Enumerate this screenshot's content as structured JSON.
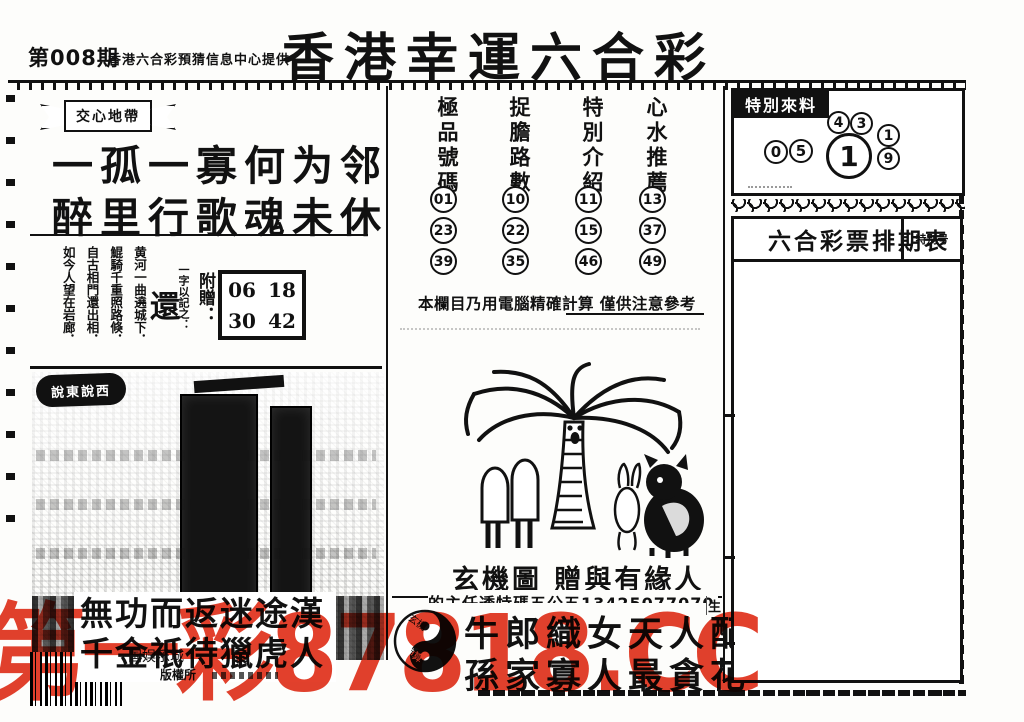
{
  "header": {
    "issue": "第008期",
    "provider": "香港六合彩預猜信息中心提供",
    "title": "香港幸運六合彩"
  },
  "left_panel": {
    "banner": "交心地帶",
    "poem_line1": "一孤一寡何为邻",
    "poem_line2": "醉里行歌魂未休",
    "verse_columns": [
      "黄河一曲遶城下．",
      "鯤騎千重照路倏．",
      "自古相門還出相．",
      "如今人望在岩廊．"
    ],
    "one_word_label": "一字以記之：",
    "one_word": "還",
    "bonus_label": "附贈：",
    "bonus_numbers": [
      [
        "06",
        "18"
      ],
      [
        "30",
        "42"
      ]
    ],
    "gossip_banner": "說東說西",
    "big_line1": "無功而返迷途漢",
    "big_line2": "千金祇待獵虎人",
    "small_text1": "国娱乐城",
    "small_text2": "版權所"
  },
  "middle_panel": {
    "columns": [
      {
        "header": "極品號碼",
        "numbers": [
          "01",
          "23",
          "39"
        ]
      },
      {
        "header": "捉膽路數",
        "numbers": [
          "10",
          "22",
          "35"
        ]
      },
      {
        "header": "特別介紹",
        "numbers": [
          "11",
          "15",
          "46"
        ]
      },
      {
        "header": "心水推薦",
        "numbers": [
          "13",
          "37",
          "49"
        ]
      }
    ],
    "note": "本欄目乃用電腦精確計算 僅供注意參考",
    "mystic_caption": "玄機圖 贈與有緣人",
    "cut_line": "的主任透特碼五公五13425077070",
    "yinyang_top": "玄機",
    "yinyang_bottom": "神算",
    "couplet_line1": "牛郎織女天人配",
    "couplet_line2": "孫家寡人最貪花",
    "corner_char": "生"
  },
  "right_panel": {
    "special_label": "特別來料",
    "special_numbers": {
      "top": [
        "4",
        "3"
      ],
      "left": [
        "0",
        "5"
      ],
      "big": "1",
      "right": [
        "1",
        "9"
      ]
    },
    "schedule_title": "六合彩票排期表",
    "schedule_corner": "特别号"
  },
  "watermark": {
    "text": "第一彩87818.CC",
    "color": "#e2402c"
  }
}
